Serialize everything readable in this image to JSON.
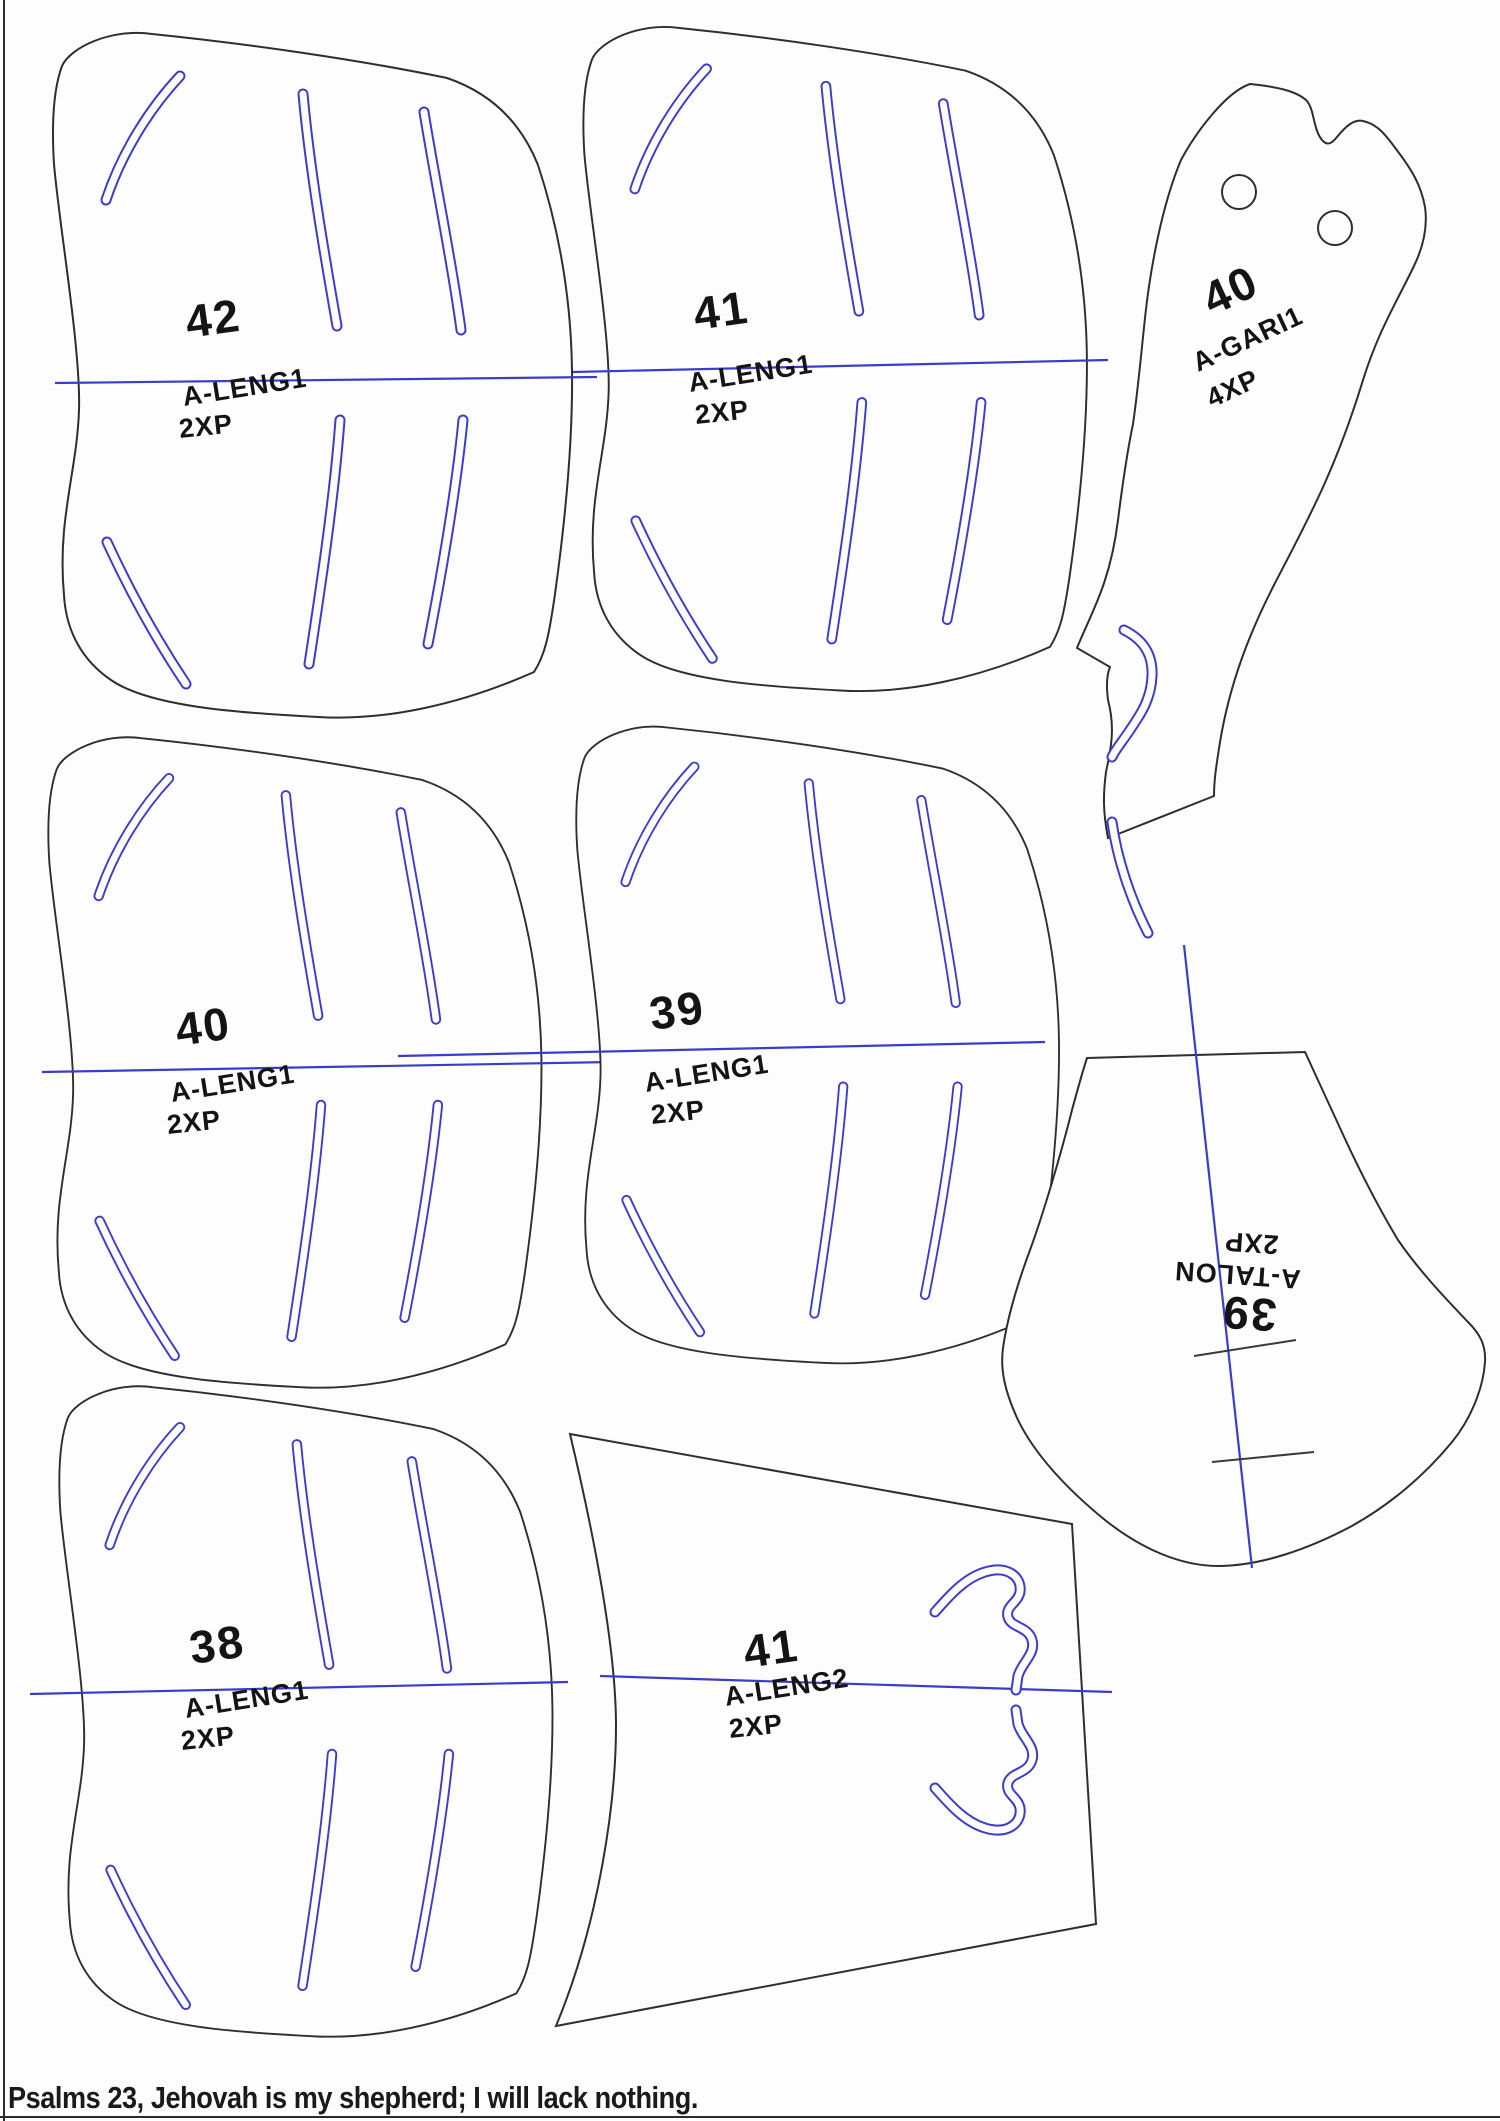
{
  "sheet": {
    "type_label": "pattern-marker-sheet",
    "footer_verse": "Psalms 23, Jehovah is my shepherd; I will lack nothing.",
    "colors": {
      "cut_outline": "#2e2e2e",
      "detail_blue": "#3c3ccb",
      "label_text": "#141414",
      "background": "#fdfdfd"
    }
  },
  "pieces": [
    {
      "size": "42",
      "name": "A-LENG1",
      "qty": "2XP"
    },
    {
      "size": "41",
      "name": "A-LENG1",
      "qty": "2XP"
    },
    {
      "size": "40",
      "name": "A-GARI1",
      "qty": "4XP"
    },
    {
      "size": "40",
      "name": "A-LENG1",
      "qty": "2XP"
    },
    {
      "size": "39",
      "name": "A-LENG1",
      "qty": "2XP"
    },
    {
      "size": "39",
      "name": "A-TALON",
      "qty": "2XP"
    },
    {
      "size": "38",
      "name": "A-LENG1",
      "qty": "2XP"
    },
    {
      "size": "41",
      "name": "A-LENG2",
      "qty": "2XP"
    }
  ]
}
